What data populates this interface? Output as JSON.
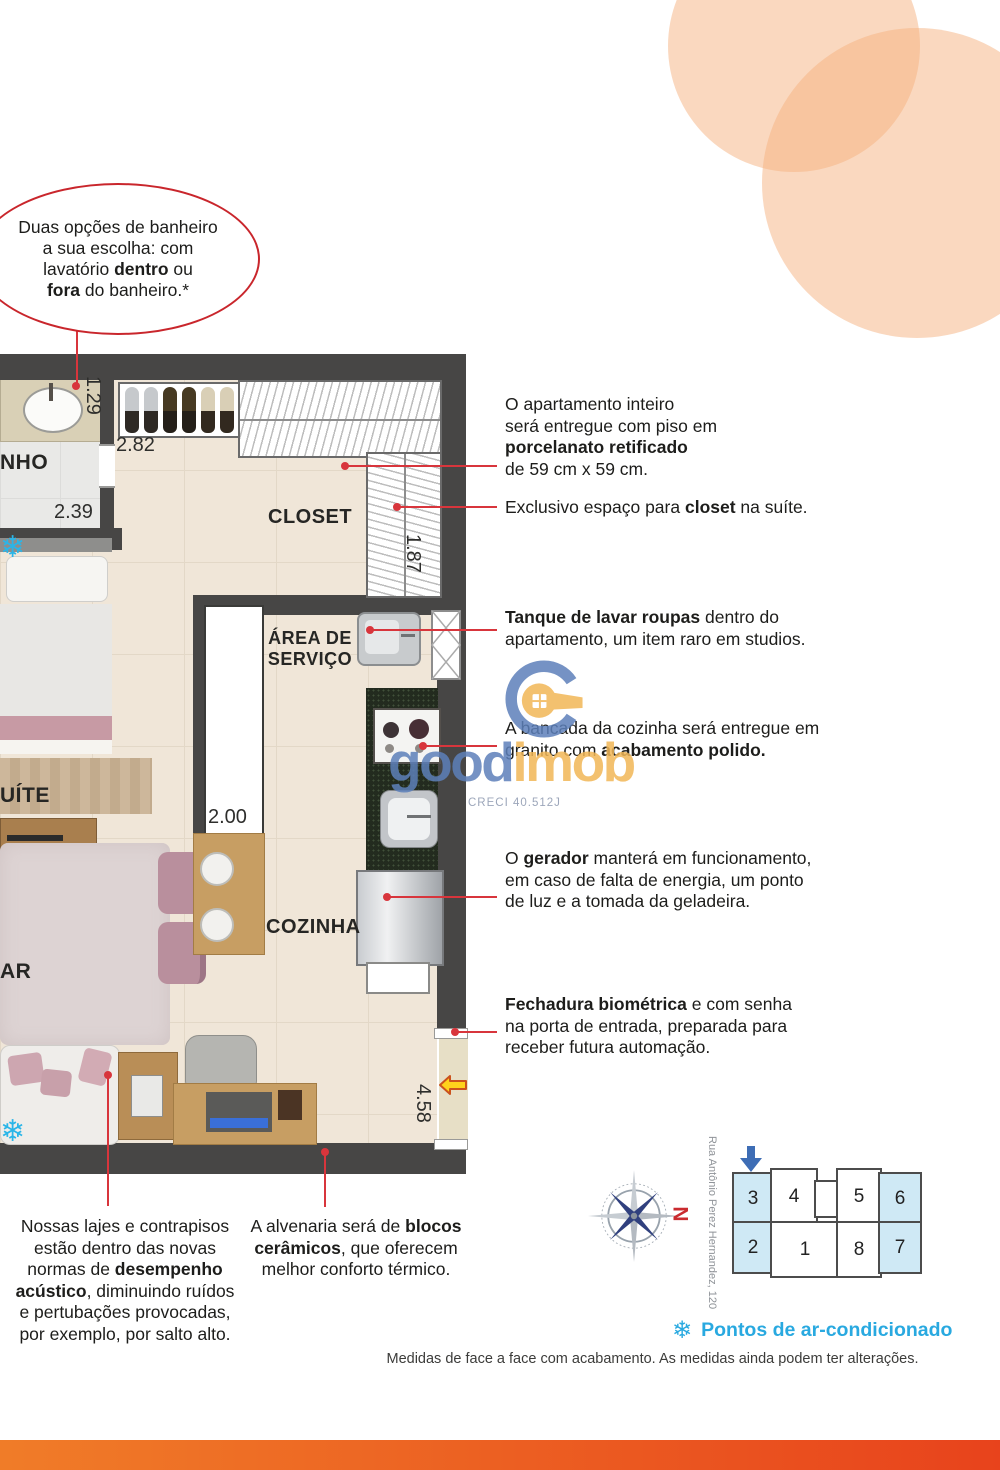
{
  "bubble": {
    "segments": [
      {
        "t": "Duas opções de banheiro\na sua escolha: com\nlavatório "
      },
      {
        "t": "dentro",
        "b": true
      },
      {
        "t": " ou\n"
      },
      {
        "t": "fora",
        "b": true
      },
      {
        "t": " do banheiro.*"
      }
    ]
  },
  "plan": {
    "rooms": {
      "banho": "NHO",
      "closet": "CLOSET",
      "servico": "ÁREA DE\nSERVIÇO",
      "cozinha": "COZINHA",
      "suite": "UÍTE",
      "estar": "AR"
    },
    "dims": {
      "d1": "1.29",
      "d2": "2.82",
      "d3": "2.39",
      "d4": "1.87",
      "d5": "2.00",
      "d6": "4.58"
    }
  },
  "annotations": {
    "right": [
      {
        "segments": [
          {
            "t": "O apartamento inteiro\nserá entregue com piso em\n"
          },
          {
            "t": "porcelanato retificado",
            "b": true
          },
          {
            "t": "\nde 59 cm x 59 cm."
          }
        ]
      },
      {
        "segments": [
          {
            "t": "Exclusivo espaço para "
          },
          {
            "t": "closet",
            "b": true
          },
          {
            "t": " na suíte."
          }
        ]
      },
      {
        "segments": [
          {
            "t": "Tanque de lavar roupas",
            "b": true
          },
          {
            "t": " dentro do\napartamento, um item raro em studios."
          }
        ]
      },
      {
        "segments": [
          {
            "t": "A bancada da cozinha será entregue em\ngranito com "
          },
          {
            "t": "acabamento polido.",
            "b": true
          }
        ]
      },
      {
        "segments": [
          {
            "t": "O "
          },
          {
            "t": "gerador",
            "b": true
          },
          {
            "t": " manterá em funcionamento,\nem caso de falta de energia, um ponto\nde luz e a tomada da geladeira."
          }
        ]
      },
      {
        "segments": [
          {
            "t": "Fechadura biométrica",
            "b": true
          },
          {
            "t": " e com senha\nna porta de entrada, preparada para\nreceber futura automação."
          }
        ]
      }
    ],
    "bottom": [
      {
        "segments": [
          {
            "t": "Nossas lajes e contrapisos\nestão dentro das novas\nnormas de "
          },
          {
            "t": "desempenho\nacústico",
            "b": true
          },
          {
            "t": ", diminuindo ruídos\ne pertubações provocadas,\npor exemplo, por salto alto."
          }
        ]
      },
      {
        "segments": [
          {
            "t": "A alvenaria será de "
          },
          {
            "t": "blocos\ncerâmicos",
            "b": true
          },
          {
            "t": ", que oferecem\nmelhor conforto térmico."
          }
        ]
      }
    ]
  },
  "logo": {
    "good": "good",
    "imob": "imob",
    "creci": "CRECI 40.512J"
  },
  "compass": {
    "north": "N"
  },
  "keyplan": {
    "street": "Rua Antônio Perez Hernandez, 120",
    "units": [
      {
        "label": "3",
        "hl": true
      },
      {
        "label": "4",
        "hl": false
      },
      {
        "label": "5",
        "hl": false
      },
      {
        "label": "6",
        "hl": true
      },
      {
        "label": "2",
        "hl": true
      },
      {
        "label": "1",
        "hl": false
      },
      {
        "label": "8",
        "hl": false
      },
      {
        "label": "7",
        "hl": true
      }
    ]
  },
  "legend": {
    "ac_label": "Pontos de ar-condicionado"
  },
  "footer": {
    "disclaimer": "Medidas de face a face com acabamento. As medidas ainda podem ter alterações."
  },
  "colors": {
    "annotation_red": "#d8353c",
    "bubble_red": "#c9262c",
    "legend_blue": "#29a9e0",
    "keyplan_highlight": "#cfe9f5",
    "keyplan_arrow_blue": "#3e6db5",
    "wall_gray": "#474645",
    "floor_beige": "#f0e6d8",
    "granite_green": "#232b1f",
    "logo_blue": "#5d80ba",
    "logo_orange": "#f2b757",
    "snowflake_blue": "#2ab5e8",
    "entrance_arrow_yellow": "#ffd21c",
    "bar_gradient_left": "#f07c28",
    "bar_gradient_right": "#e8431c"
  }
}
